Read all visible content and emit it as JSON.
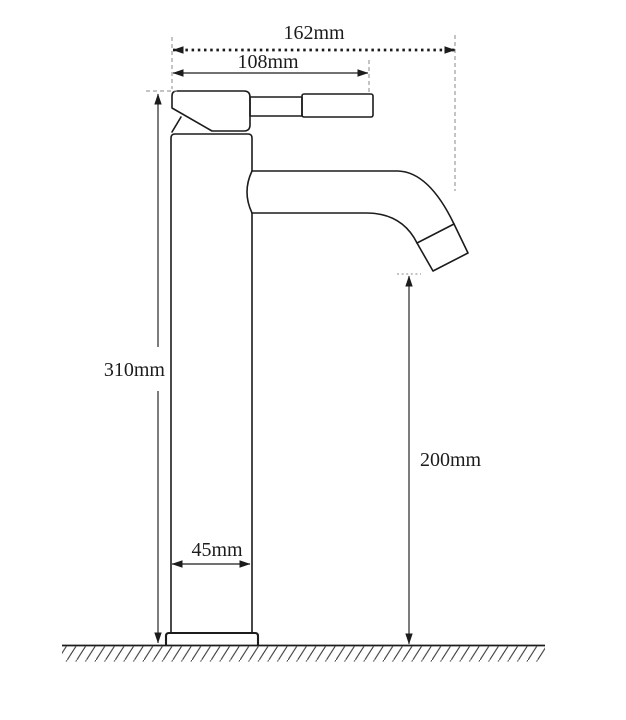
{
  "diagram": {
    "unit": "mm",
    "labels": {
      "overall_width": "162mm",
      "handle_length": "108mm",
      "total_height": "310mm",
      "spout_outlet_height": "200mm",
      "body_width": "45mm"
    },
    "colors": {
      "line": "#1c1c1c",
      "extension": "#8a8a8a",
      "background": "#ffffff"
    }
  }
}
